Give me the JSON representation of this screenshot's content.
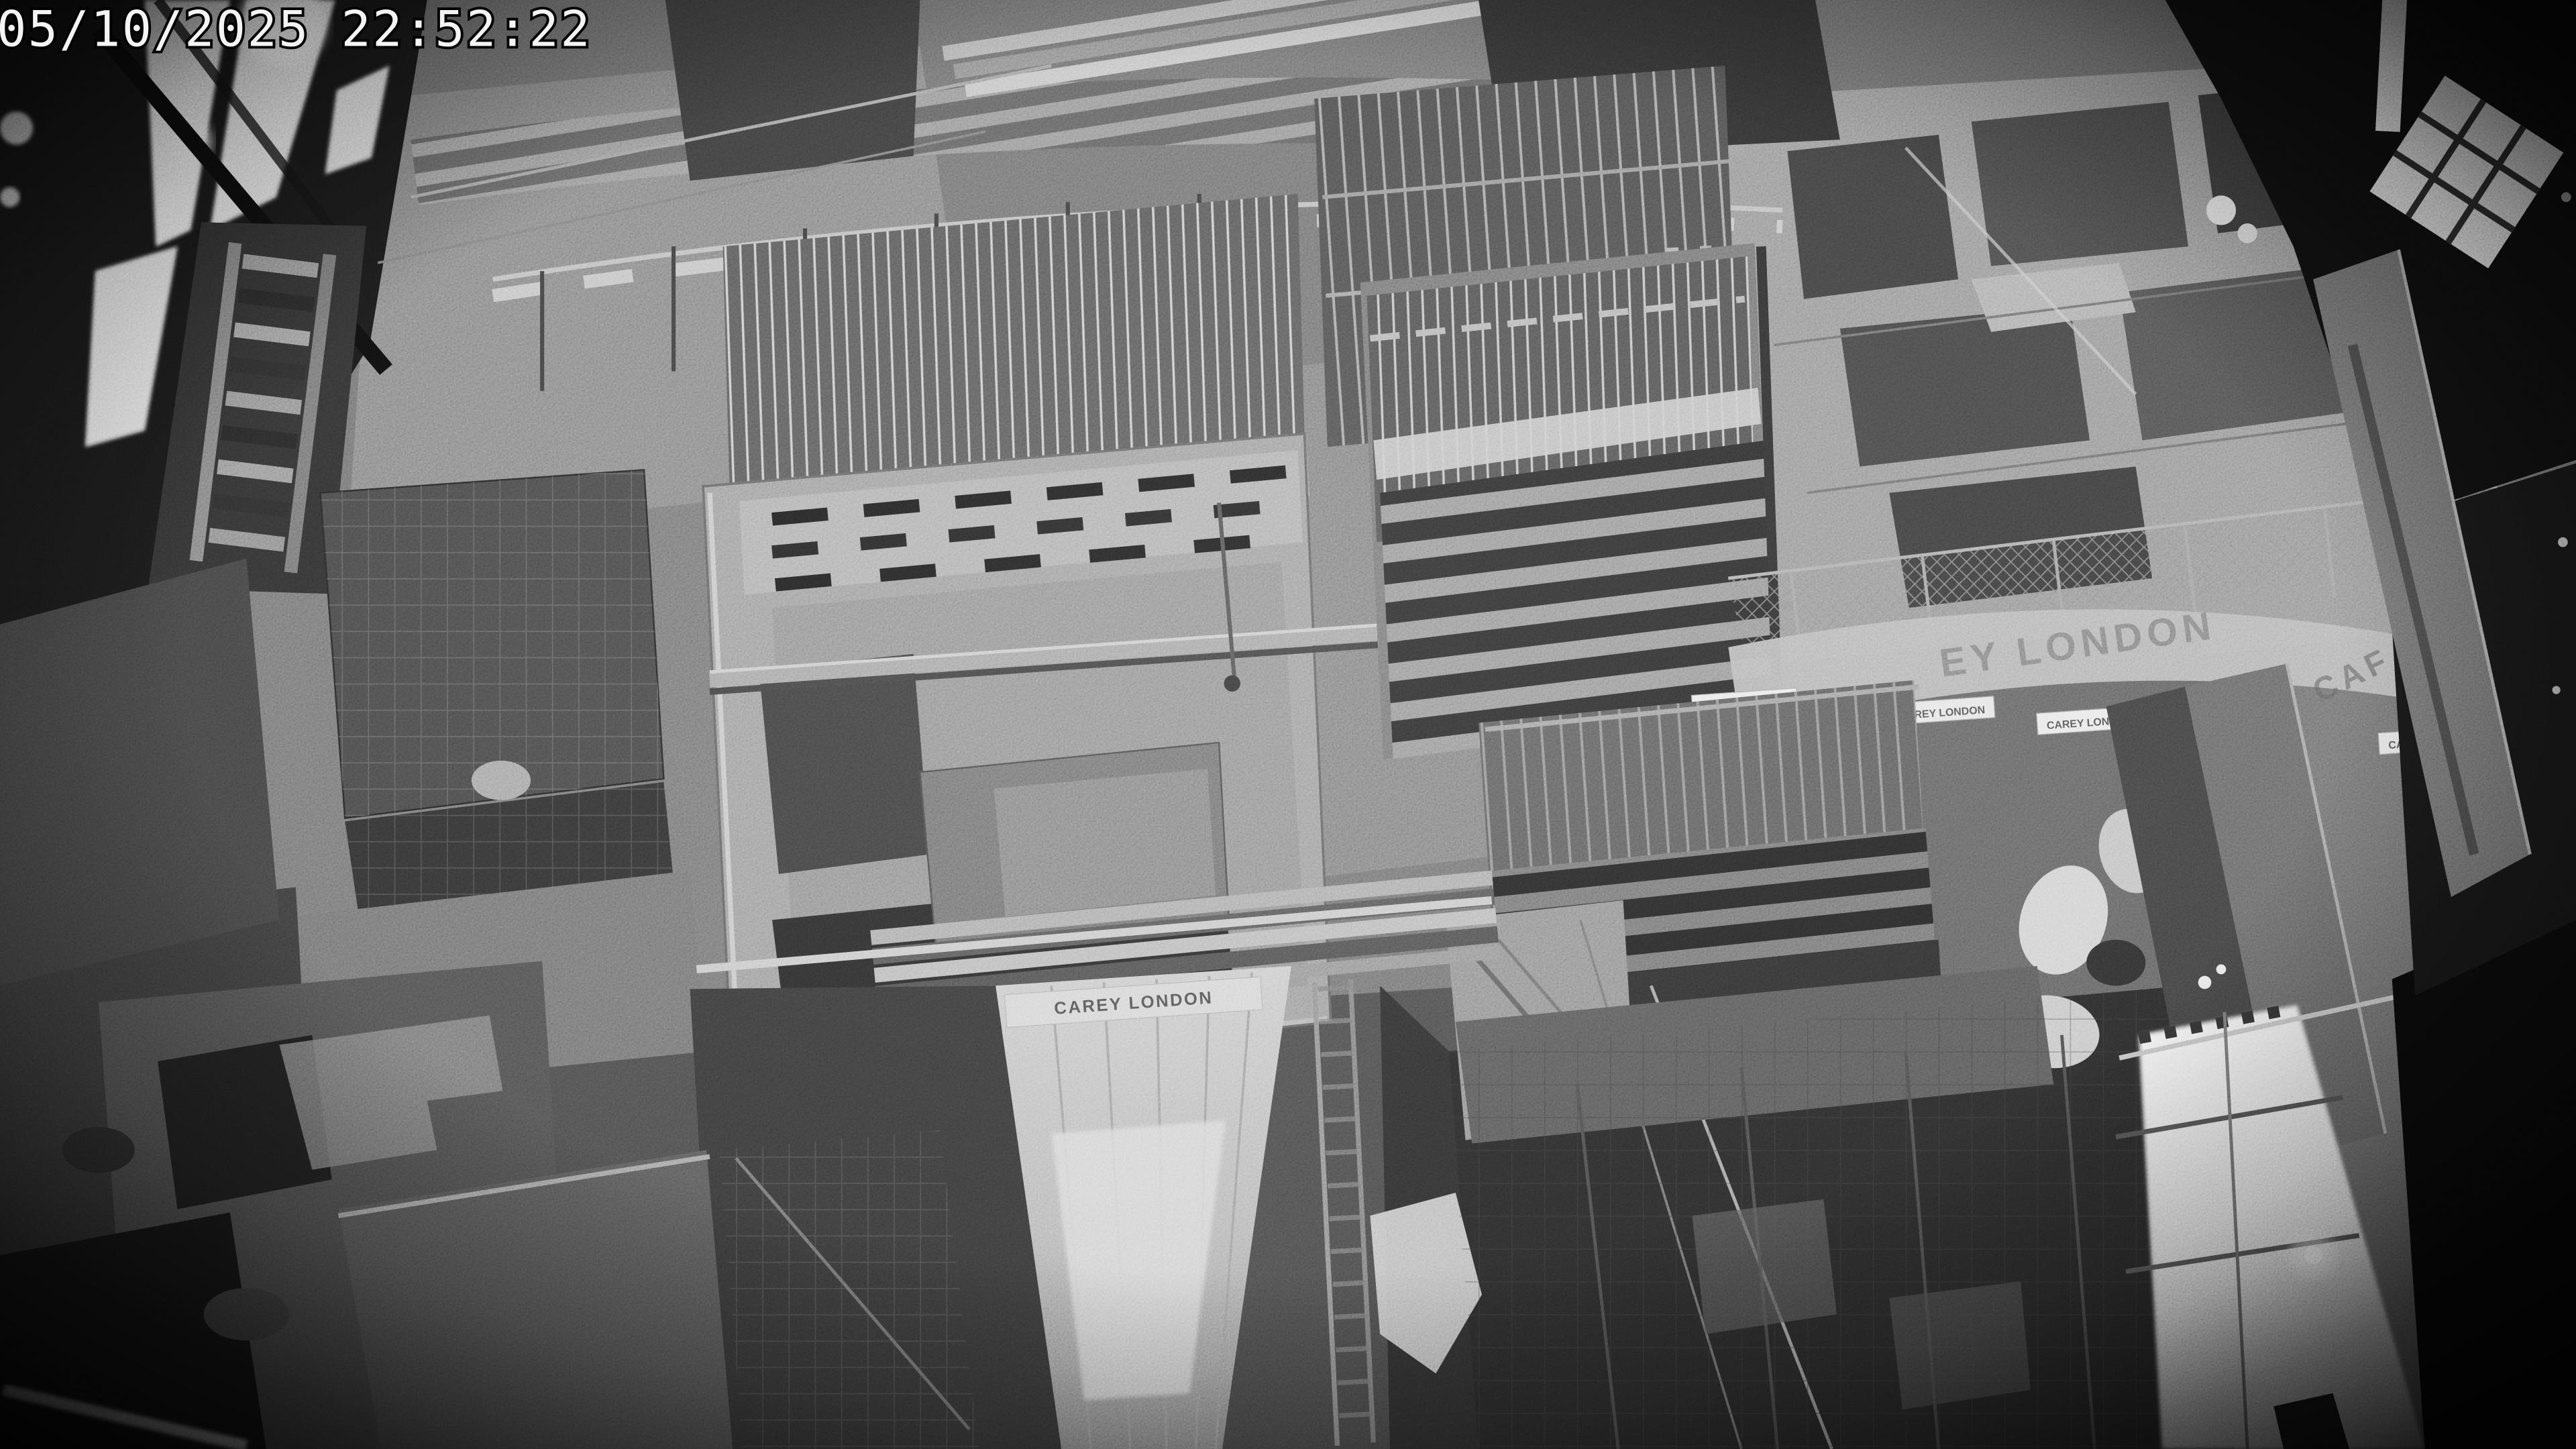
{
  "osd": {
    "timestamp": "05/10/2025 22:52:22"
  },
  "banners": {
    "edge_banner_partial_left": "EY LONDON",
    "edge_banner_partial_right": "CAF",
    "wall_sign_text": "CAREY LONDON",
    "small_signs": [
      "CAREY LONDON",
      "CAREY LONDON",
      "CAREY LONDON",
      "CAREY LONDON",
      "CAREY LONDON"
    ]
  },
  "palette": {
    "base_gray": "#6d6d6d",
    "highlight_white": "#f2f2f2",
    "shadow_black": "#0a0a0a",
    "osd_text": "#f4f4f4",
    "osd_outline": "#000000"
  }
}
